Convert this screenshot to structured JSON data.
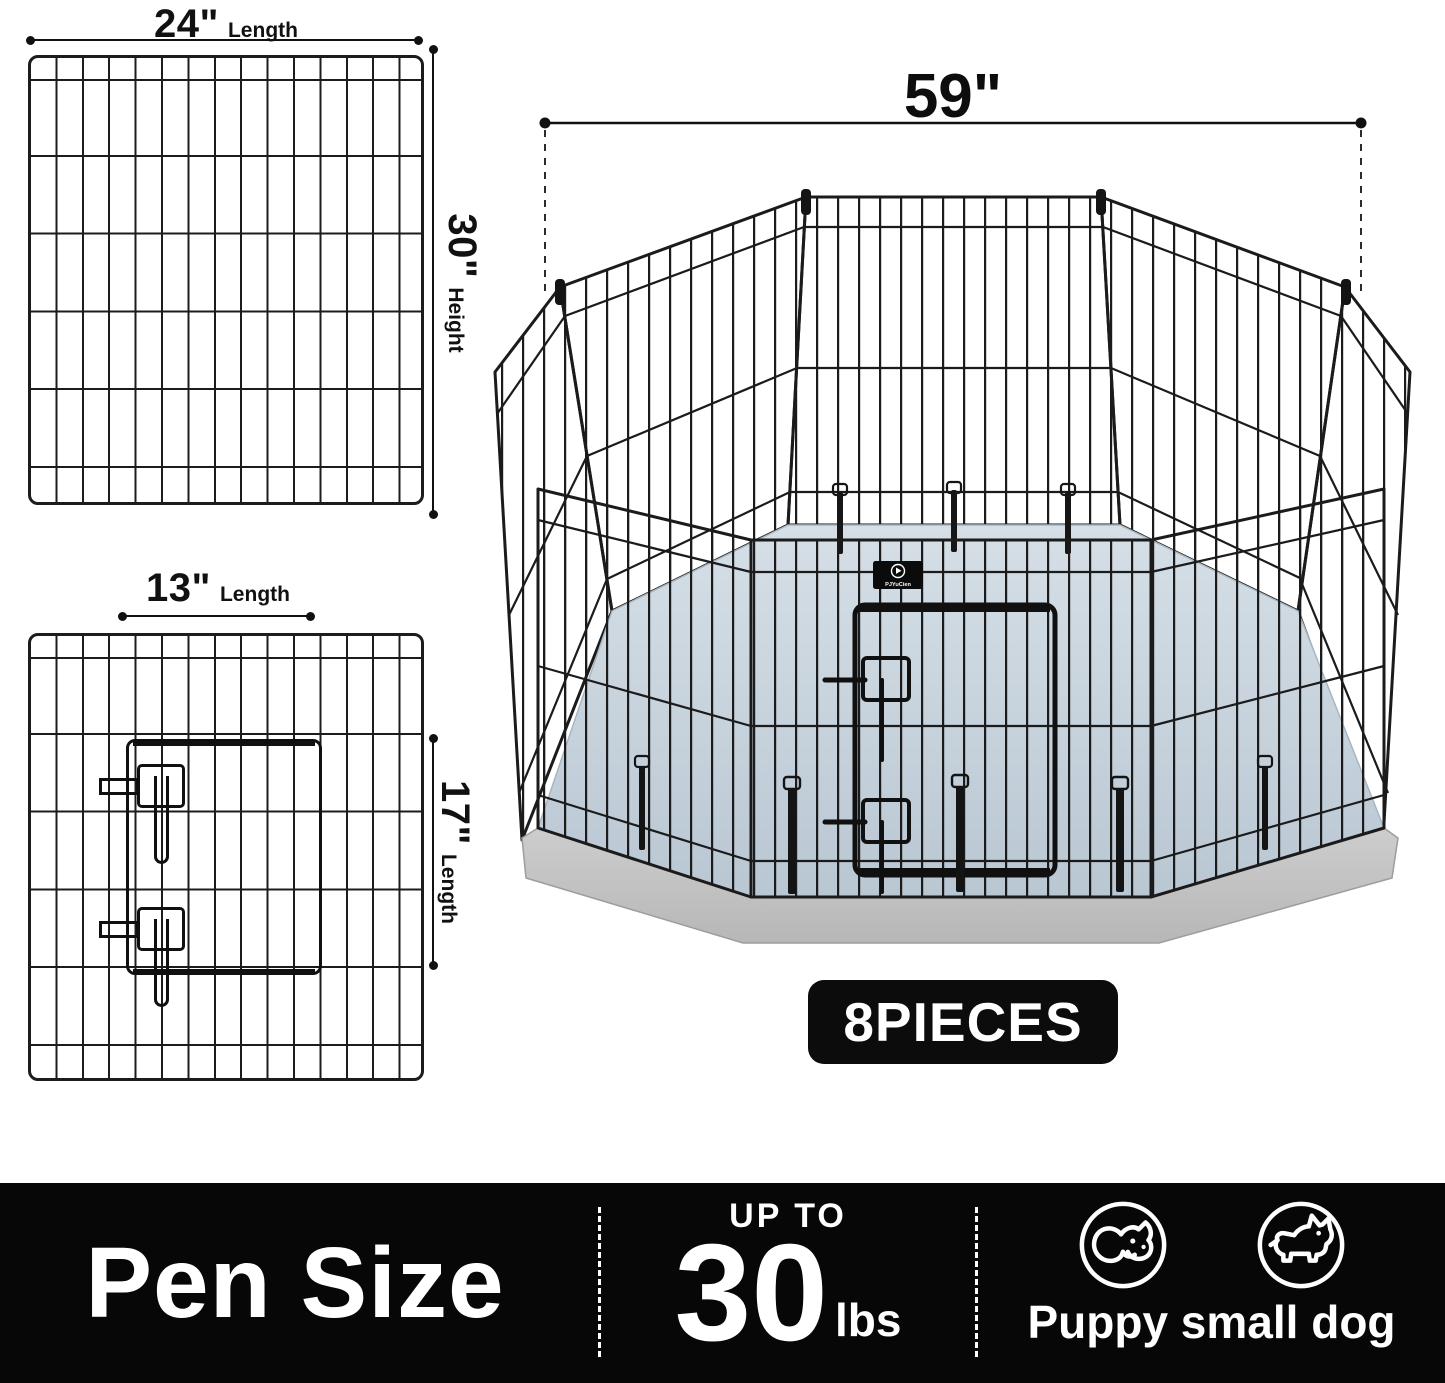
{
  "brand": {
    "logo_text": "PJYuCien",
    "logo_icon": "dog-flag-icon"
  },
  "dims": {
    "full_length": {
      "value": "24\"",
      "label": "Length"
    },
    "full_height": {
      "value": "30\"",
      "label": "Height"
    },
    "door_length": {
      "value": "13\"",
      "label": "Length"
    },
    "door_height": {
      "value": "17\"",
      "label": "Length"
    },
    "pen_width": {
      "value": "59\""
    }
  },
  "badge": {
    "pieces": "8PIECES"
  },
  "footer": {
    "title": "Pen Size",
    "weight": {
      "prefix": "UP TO",
      "value": "30",
      "unit": "lbs"
    },
    "pets": {
      "label": "Puppy small dog",
      "icons": [
        "puppy-face-icon",
        "small-dog-icon"
      ]
    }
  },
  "colors": {
    "wire": "#1b1b1b",
    "floor_top": "#d6dfe6",
    "floor_bottom": "#b9c7d3",
    "skirt": "#c9c9c9",
    "badge_bg": "#0c0c0c",
    "footer_bg": "#070707",
    "text_light": "#ffffff",
    "text_dark": "#111111"
  }
}
